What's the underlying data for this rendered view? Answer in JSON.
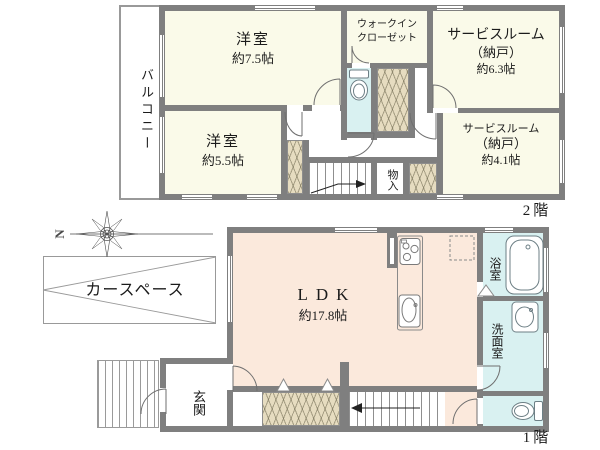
{
  "floor2": {
    "floor_label": "2階",
    "balcony_label": "バルコニー",
    "room_75": {
      "name": "洋室",
      "size": "約7.5帖"
    },
    "wic": {
      "line1": "ウォークイン",
      "line2": "クローゼット"
    },
    "service_63": {
      "name": "サービスルーム",
      "alt": "（納戸）",
      "size": "約6.3帖"
    },
    "room_55": {
      "name": "洋室",
      "size": "約5.5帖"
    },
    "service_41": {
      "name": "サービスルーム",
      "alt": "（納戸）",
      "size": "約4.1帖"
    },
    "storage_label": "物入"
  },
  "floor1": {
    "floor_label": "1階",
    "ldk": {
      "name": "LDK",
      "size": "約17.8帖"
    },
    "car_space_label": "カースペース",
    "bath_label": "浴室",
    "washroom_label": "洗面室",
    "entrance_label": "玄関",
    "compass_north": "N"
  },
  "colors": {
    "wall": "#7f7f7f",
    "room_cream": "#fafae9",
    "ldk_pink": "#fbe9dc",
    "wet_cyan": "#d9f1f1",
    "closet_beige": "#e6dcc0",
    "thin_line": "#999999"
  }
}
